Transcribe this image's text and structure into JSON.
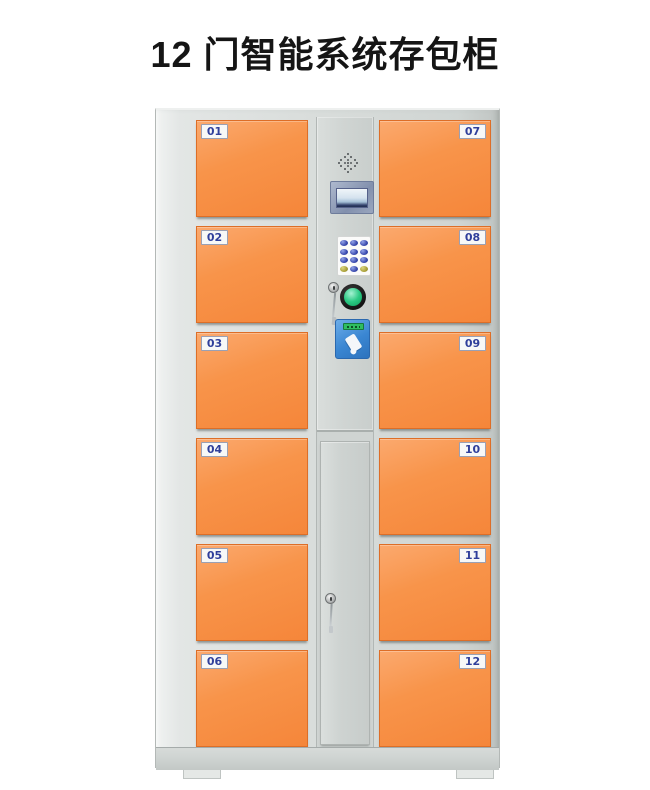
{
  "title": "12 门智能系统存包柜",
  "cabinet": {
    "doors": {
      "left": [
        {
          "number": "01"
        },
        {
          "number": "02"
        },
        {
          "number": "03"
        },
        {
          "number": "04"
        },
        {
          "number": "05"
        },
        {
          "number": "06"
        }
      ],
      "right": [
        {
          "number": "07"
        },
        {
          "number": "08"
        },
        {
          "number": "09"
        },
        {
          "number": "10"
        },
        {
          "number": "11"
        },
        {
          "number": "12"
        }
      ]
    },
    "control_panel": {
      "components": [
        "speaker",
        "lcd-display",
        "numeric-keypad",
        "key-lock",
        "confirm-button",
        "card-reader"
      ]
    },
    "colors": {
      "door_orange": "#f5863a",
      "frame_gray": "#d9dddb",
      "column_gray": "#cfd4d2",
      "label_text_blue": "#2f3f9b",
      "confirm_green": "#2bc983",
      "card_reader_blue": "#3a86d2",
      "keypad_blue": "#3a4aae",
      "keypad_yellow": "#a59c35"
    }
  }
}
